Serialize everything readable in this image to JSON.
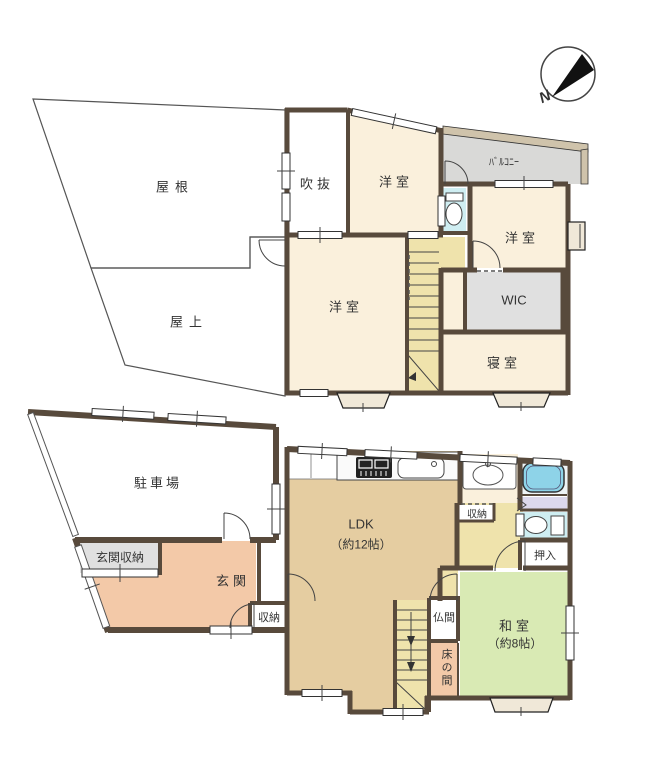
{
  "compass": {
    "north_label": "N"
  },
  "floor2": {
    "roof_label": "屋根",
    "rooftop_label": "屋上",
    "void_label": "吹抜",
    "western_room_top_label": "洋室",
    "balcony_label": "ﾊﾞﾙｺﾆｰ",
    "western_room_right_label": "洋室",
    "wic_label": "WIC",
    "bedroom_label": "寝室",
    "western_room_large_label": "洋室"
  },
  "floor1": {
    "parking_label": "駐車場",
    "entrance_storage_label": "玄関収納",
    "entrance_label": "玄関",
    "entrance_closet_label": "収納",
    "ldk_label": "LDK",
    "ldk_size_label": "（約12帖）",
    "hall_closet_label": "収納",
    "oshiire_label": "押入",
    "japanese_room_label": "和室",
    "japanese_room_size_label": "（約8帖）",
    "butsuma_label": "仏間",
    "tokonoma_label": "床の間"
  },
  "palette": {
    "wall": "#584a3c",
    "cream_room": "#faf0dc",
    "gray_room": "#e0e0e0",
    "balcony_gray": "#d9d9d7",
    "balcony_rail": "#cfc3ab",
    "stairs_hall_khaki": "#efe3ac",
    "ldk_tan": "#e5cda1",
    "entrance_salmon": "#f3c9a8",
    "tatami_green": "#d9eab4",
    "toilet_cyan": "#cfeef2",
    "bath_blue": "#8ed3e8",
    "lavender": "#dcd8ec",
    "bay_window": "#f0e8d8"
  }
}
